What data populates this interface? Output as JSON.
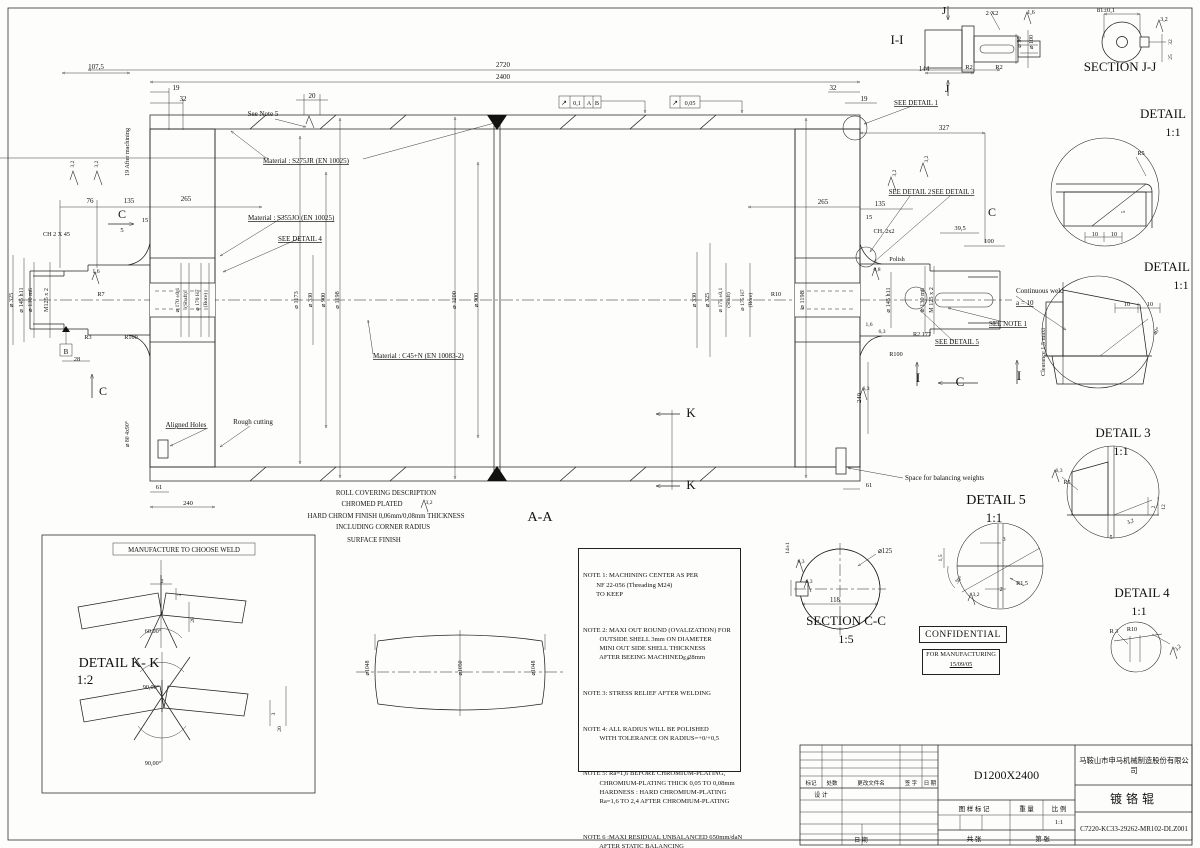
{
  "title_block": {
    "company": "马鞍山市申马机械制造股份有限公司",
    "part_name": "镀铬辊",
    "model": "D1200X2400",
    "drawing_number": "C7220-KC33-29262-MR102-DLZ001",
    "scale_value": "1:1",
    "col_mark": "标记",
    "col_count": "处数",
    "col_file": "更改文件名",
    "col_sign": "签 字",
    "col_date": "日 期",
    "design": "设 计",
    "date": "日 期",
    "pattern_mark": "图 样 标 记",
    "weight": "重 量",
    "scale": "比 例",
    "sheets_total": "共    张",
    "sheet_no": "第    张"
  },
  "confidential": {
    "label": "CONFIDENTIAL",
    "for_mfg": "FOR MANUFACTURING",
    "date": "15/09/05"
  },
  "notes": [
    "NOTE 1: MACHINING CENTER AS PER\n        NF 22-056 (Threading M24)\n        TO KEEP",
    "NOTE 2: MAXI OUT ROUND (OVALIZATION) FOR\n          OUTSIDE SHELL 3mm ON DIAMETER\n          MINI OUT SIDE SHELL THICKNESS\n          AFTER BEEING MACHINED : 28mm",
    "NOTE 3: STRESS RELIEF AFTER WELDING",
    "NOTE 4: ALL RADIUS WILL BE POLISHED\n          WITH TOLERANCE ON RADIUS=+0/+0,5",
    "NOTE 5: Ra=1,6 BEFORE CHROMIUM-PLATING,\n          CHROMIUM-PLATING THICK 0,05 TO 0,08mm\n          HARDNESS : HARD CHROMIUM-PLATING\n          Ra=1,6 TO 2,4 AFTER CHROMIUM-PLATING",
    "NOTE 6 :MAXI RESIDUAL UNBALANCED 650mm/daN\n          AFTER STATIC BALANCING"
  ],
  "labels": [
    {
      "t": "107,5",
      "x": 96,
      "y": 69
    },
    {
      "t": "2720",
      "x": 503,
      "y": 67
    },
    {
      "t": "2400",
      "x": 503,
      "y": 79
    },
    {
      "t": "19",
      "x": 176,
      "y": 90
    },
    {
      "t": "32",
      "x": 183,
      "y": 101
    },
    {
      "t": "20",
      "x": 312,
      "y": 98
    },
    {
      "t": "32",
      "x": 833,
      "y": 90
    },
    {
      "t": "19",
      "x": 864,
      "y": 101
    },
    {
      "t": "144",
      "x": 924,
      "y": 71
    },
    {
      "t": "2 X2",
      "x": 992,
      "y": 15,
      "s": 6.5
    },
    {
      "t": "1,6",
      "x": 1031,
      "y": 14,
      "s": 6
    },
    {
      "t": "R2",
      "x": 969,
      "y": 69,
      "s": 6.5
    },
    {
      "t": "R2",
      "x": 999,
      "y": 69,
      "s": 6.5
    },
    {
      "t": "J",
      "x": 944,
      "y": 14,
      "s": 11,
      "n": "section-mark-j"
    },
    {
      "t": "J",
      "x": 947,
      "y": 92,
      "s": 11,
      "n": "section-mark-j"
    },
    {
      "t": "I-I",
      "x": 897,
      "y": 44,
      "s": 13,
      "n": "view-label"
    },
    {
      "t": "⌀ 90",
      "x": 1021,
      "y": 42,
      "r": -90,
      "s": 6
    },
    {
      "t": "⌀ 100",
      "x": 1033,
      "y": 42,
      "r": -90,
      "s": 6
    },
    {
      "t": "81±0,1",
      "x": 1106,
      "y": 12,
      "s": 6.5
    },
    {
      "t": "3,2",
      "x": 1164,
      "y": 21,
      "s": 6
    },
    {
      "t": "32",
      "x": 1172,
      "y": 42,
      "r": -90,
      "s": 5.5
    },
    {
      "t": "25",
      "x": 1172,
      "y": 57,
      "r": -90,
      "s": 5.5
    },
    {
      "t": "SECTION J-J",
      "x": 1120,
      "y": 71,
      "s": 13,
      "n": "view-label"
    },
    {
      "t": "SEE DETAIL 1",
      "x": 916,
      "y": 105,
      "s": 7,
      "u": 1
    },
    {
      "t": "See Note 5",
      "x": 263,
      "y": 116,
      "s": 7
    },
    {
      "t": "19 After machining",
      "x": 129,
      "y": 152,
      "r": -90,
      "s": 6.2
    },
    {
      "t": "Material : S275JR (EN 10025)",
      "x": 263,
      "y": 163,
      "s": 7,
      "u": 1,
      "a": "start"
    },
    {
      "t": "Material : S355JO (EN 10025)",
      "x": 248,
      "y": 220,
      "s": 7,
      "u": 1,
      "a": "start"
    },
    {
      "t": "SEE DETAIL 4",
      "x": 278,
      "y": 241,
      "s": 7,
      "u": 1,
      "a": "start"
    },
    {
      "t": "Material : C45+N (EN 10083-2)",
      "x": 373,
      "y": 358,
      "s": 7,
      "u": 1,
      "a": "start"
    },
    {
      "t": "76",
      "x": 90,
      "y": 203
    },
    {
      "t": "135",
      "x": 129,
      "y": 203
    },
    {
      "t": "265",
      "x": 186,
      "y": 201
    },
    {
      "t": "C",
      "x": 122,
      "y": 218,
      "s": 12,
      "n": "section-mark-c"
    },
    {
      "t": "15",
      "x": 145,
      "y": 222,
      "s": 6.5
    },
    {
      "t": "5",
      "x": 122,
      "y": 232,
      "s": 6.5
    },
    {
      "t": "CH 2 X 45",
      "x": 43,
      "y": 236,
      "s": 6.2,
      "a": "start"
    },
    {
      "t": "3,2",
      "x": 74,
      "y": 164,
      "r": -90,
      "s": 5.5
    },
    {
      "t": "3,2",
      "x": 98,
      "y": 164,
      "r": -90,
      "s": 5.5
    },
    {
      "t": "⌀ 325",
      "x": 13,
      "y": 300,
      "r": -90,
      "s": 6.2
    },
    {
      "t": "⌀ 145 h11",
      "x": 23,
      "y": 300,
      "r": -90,
      "s": 6.2
    },
    {
      "t": "⌀ 130 m6",
      "x": 32,
      "y": 300,
      "r": -90,
      "s": 6.2
    },
    {
      "t": "M125 x 2",
      "x": 48,
      "y": 300,
      "r": -90,
      "s": 6.2
    },
    {
      "t": "R7",
      "x": 101,
      "y": 296,
      "s": 6.2
    },
    {
      "t": "1,6",
      "x": 96,
      "y": 273,
      "s": 5.8
    },
    {
      "t": "R3",
      "x": 88,
      "y": 339,
      "s": 6.2
    },
    {
      "t": "R100",
      "x": 131,
      "y": 339,
      "s": 6.2
    },
    {
      "t": "28",
      "x": 77,
      "y": 361,
      "s": 6.5
    },
    {
      "t": "C",
      "x": 103,
      "y": 395,
      "s": 12,
      "n": "section-mark-c"
    },
    {
      "t": "B",
      "x": 66,
      "y": 354,
      "s": 7,
      "n": "datum-label"
    },
    {
      "t": "⌀ 170 ±0,1",
      "x": 179,
      "y": 300,
      "r": -90,
      "s": 5.6
    },
    {
      "t": "(Shaft)",
      "x": 187,
      "y": 300,
      "r": -90,
      "s": 5.6
    },
    {
      "t": "⌀ 170 H7",
      "x": 199,
      "y": 300,
      "r": -90,
      "s": 5.6
    },
    {
      "t": "(Bore)",
      "x": 207,
      "y": 300,
      "r": -90,
      "s": 5.6
    },
    {
      "t": "⌀ 1173",
      "x": 298,
      "y": 300,
      "r": -90,
      "s": 6.2
    },
    {
      "t": "⌀ 330",
      "x": 312,
      "y": 300,
      "r": -90,
      "s": 6.2
    },
    {
      "t": "⌀ 900",
      "x": 325,
      "y": 300,
      "r": -90,
      "s": 6.2
    },
    {
      "t": "⌀ 1198",
      "x": 339,
      "y": 300,
      "r": -90,
      "s": 6.2
    },
    {
      "t": "⌀ 1200",
      "x": 456,
      "y": 300,
      "r": -90,
      "s": 6.2
    },
    {
      "t": "⌀ 900",
      "x": 478,
      "y": 300,
      "r": -90,
      "s": 6.2
    },
    {
      "t": "⌀ 330",
      "x": 696,
      "y": 300,
      "r": -90,
      "s": 6.2
    },
    {
      "t": "⌀ 325",
      "x": 709,
      "y": 300,
      "r": -90,
      "s": 6.2
    },
    {
      "t": "⌀ 175 ±0,1",
      "x": 722,
      "y": 300,
      "r": -90,
      "s": 5.6
    },
    {
      "t": "(Shaft)",
      "x": 730,
      "y": 300,
      "r": -90,
      "s": 5.6
    },
    {
      "t": "⌀ 175 H7",
      "x": 744,
      "y": 300,
      "r": -90,
      "s": 5.6
    },
    {
      "t": "(Bore)",
      "x": 752,
      "y": 300,
      "r": -90,
      "s": 5.6
    },
    {
      "t": "R10",
      "x": 776,
      "y": 296,
      "s": 6.2
    },
    {
      "t": "⌀ 1198",
      "x": 804,
      "y": 300,
      "r": -90,
      "s": 6.2
    },
    {
      "t": "265",
      "x": 823,
      "y": 204
    },
    {
      "t": "135",
      "x": 880,
      "y": 206
    },
    {
      "t": "15",
      "x": 869,
      "y": 219,
      "s": 6.5
    },
    {
      "t": "CH. 2x2",
      "x": 884,
      "y": 233,
      "s": 6.2
    },
    {
      "t": "39,5",
      "x": 960,
      "y": 230,
      "s": 6.5
    },
    {
      "t": "100",
      "x": 989,
      "y": 243,
      "s": 6.5
    },
    {
      "t": "Polish",
      "x": 897,
      "y": 261,
      "s": 6.2
    },
    {
      "t": "0,8",
      "x": 877,
      "y": 271,
      "s": 5.6
    },
    {
      "t": "C",
      "x": 992,
      "y": 216,
      "s": 12,
      "n": "section-mark-c"
    },
    {
      "t": "3,2",
      "x": 896,
      "y": 173,
      "r": -90,
      "s": 5.5
    },
    {
      "t": "3,2",
      "x": 928,
      "y": 159,
      "r": -90,
      "s": 5.5
    },
    {
      "t": "327",
      "x": 944,
      "y": 130
    },
    {
      "t": "SEE DETAIL 2",
      "x": 910,
      "y": 194,
      "s": 6.8,
      "u": 1
    },
    {
      "t": "SEE DETAIL 3",
      "x": 953,
      "y": 194,
      "s": 6.8,
      "u": 1
    },
    {
      "t": "⌀ 145 h11",
      "x": 890,
      "y": 300,
      "r": -90,
      "s": 6.2
    },
    {
      "t": "⌀ 130 m6",
      "x": 924,
      "y": 300,
      "r": -90,
      "s": 6.2
    },
    {
      "t": "M 125 x 2",
      "x": 933,
      "y": 300,
      "r": -90,
      "s": 6.2
    },
    {
      "t": "R2 177",
      "x": 922,
      "y": 336,
      "s": 6.2
    },
    {
      "t": "R100",
      "x": 896,
      "y": 356,
      "s": 6.2
    },
    {
      "t": "6,3",
      "x": 882,
      "y": 333,
      "s": 5.6
    },
    {
      "t": "1,6",
      "x": 869,
      "y": 326,
      "s": 5.6
    },
    {
      "t": "SEE NOTE 1",
      "x": 1008,
      "y": 326,
      "s": 7,
      "u": 1
    },
    {
      "t": "SEE DETAIL 5",
      "x": 957,
      "y": 344,
      "s": 7,
      "u": 1
    },
    {
      "t": "Continuous weld",
      "x": 1016,
      "y": 293,
      "s": 7,
      "a": "start"
    },
    {
      "t": "a = 10",
      "x": 1016,
      "y": 305,
      "s": 7,
      "a": "start",
      "u": 1
    },
    {
      "t": "Clearance 1,5 maxi",
      "x": 1045,
      "y": 352,
      "r": -90,
      "s": 6.2
    },
    {
      "t": "I",
      "x": 918,
      "y": 382,
      "s": 13,
      "n": "section-mark-i"
    },
    {
      "t": "I",
      "x": 1019,
      "y": 380,
      "s": 13,
      "n": "section-mark-i"
    },
    {
      "t": "C",
      "x": 960,
      "y": 386,
      "s": 13,
      "n": "section-mark-c"
    },
    {
      "t": "240",
      "x": 861,
      "y": 398,
      "r": -90,
      "s": 6.5
    },
    {
      "t": "61",
      "x": 869,
      "y": 487,
      "s": 6.5
    },
    {
      "t": "6,3",
      "x": 866,
      "y": 390,
      "s": 5.6
    },
    {
      "t": "Space for balancing weights",
      "x": 905,
      "y": 480,
      "s": 7,
      "a": "start"
    },
    {
      "t": "⌀ 80 4x90°",
      "x": 129,
      "y": 434,
      "r": -90,
      "s": 5.8
    },
    {
      "t": "Aligned Holes",
      "x": 186,
      "y": 427,
      "s": 7,
      "u": 1
    },
    {
      "t": "Rough cutting",
      "x": 253,
      "y": 424,
      "s": 7
    },
    {
      "t": "61",
      "x": 159,
      "y": 489,
      "s": 6.5
    },
    {
      "t": "240",
      "x": 188,
      "y": 505,
      "s": 6.5
    },
    {
      "t": "K",
      "x": 691,
      "y": 417,
      "s": 13,
      "n": "section-mark-k"
    },
    {
      "t": "K",
      "x": 691,
      "y": 489,
      "s": 13,
      "n": "section-mark-k"
    },
    {
      "t": "A-A",
      "x": 540,
      "y": 521,
      "s": 14,
      "n": "view-label"
    },
    {
      "t": "ROLL COVERING DESCRIPTION",
      "x": 386,
      "y": 495,
      "s": 6.8
    },
    {
      "t": "CHROMED PLATED",
      "x": 372,
      "y": 506,
      "s": 6.8
    },
    {
      "t": "3,2",
      "x": 429,
      "y": 504,
      "s": 5.6
    },
    {
      "t": "HARD CHROM FINISH 0,06mm/0,08mm THICKNESS",
      "x": 386,
      "y": 518,
      "s": 6.8
    },
    {
      "t": "INCLUDING CORNER RADIUS",
      "x": 383,
      "y": 529,
      "s": 6.8
    },
    {
      "t": "SURFACE FINISH",
      "x": 374,
      "y": 542,
      "s": 6.8
    },
    {
      "t": "10",
      "x": 1095,
      "y": 236,
      "s": 6.2
    },
    {
      "t": "10",
      "x": 1114,
      "y": 236,
      "s": 6.2
    },
    {
      "t": "5",
      "x": 1125,
      "y": 212,
      "r": -90,
      "s": 5.6
    },
    {
      "t": "R5",
      "x": 1141,
      "y": 155,
      "s": 6.2
    },
    {
      "t": "DETAIL",
      "x": 1163,
      "y": 118,
      "s": 13,
      "n": "view-label"
    },
    {
      "t": "1:1",
      "x": 1173,
      "y": 136,
      "s": 12
    },
    {
      "t": "DETAIL",
      "x": 1167,
      "y": 271,
      "s": 13,
      "n": "view-label"
    },
    {
      "t": "1:1",
      "x": 1181,
      "y": 289,
      "s": 12
    },
    {
      "t": "10",
      "x": 1127,
      "y": 306,
      "s": 6.2
    },
    {
      "t": "10",
      "x": 1150,
      "y": 306,
      "s": 6.2
    },
    {
      "t": "40°",
      "x": 1158,
      "y": 332,
      "r": -60,
      "s": 5.8
    },
    {
      "t": "DETAIL 3",
      "x": 1123,
      "y": 437,
      "s": 13,
      "n": "view-label"
    },
    {
      "t": "1:1",
      "x": 1121,
      "y": 455,
      "s": 12
    },
    {
      "t": "6,3",
      "x": 1059,
      "y": 472,
      "s": 5.6
    },
    {
      "t": "R5",
      "x": 1067,
      "y": 484,
      "s": 6
    },
    {
      "t": "5",
      "x": 1111,
      "y": 539,
      "s": 6.2
    },
    {
      "t": "3,2",
      "x": 1131,
      "y": 523,
      "r": -20,
      "s": 5.6
    },
    {
      "t": "2",
      "x": 1155,
      "y": 507,
      "r": -90,
      "s": 5.6
    },
    {
      "t": "12",
      "x": 1165,
      "y": 507,
      "r": -90,
      "s": 5.6
    },
    {
      "t": "DETAIL 5",
      "x": 996,
      "y": 504,
      "s": 14,
      "n": "view-label"
    },
    {
      "t": "1:1",
      "x": 994,
      "y": 522,
      "s": 13
    },
    {
      "t": "3",
      "x": 1004,
      "y": 541,
      "s": 6.2
    },
    {
      "t": "1,5",
      "x": 942,
      "y": 558,
      "r": -90,
      "s": 5.6
    },
    {
      "t": "30°",
      "x": 960,
      "y": 581,
      "r": -45,
      "s": 5.6
    },
    {
      "t": "3,2",
      "x": 976,
      "y": 596,
      "s": 5.6
    },
    {
      "t": "2",
      "x": 1001,
      "y": 591,
      "s": 6.2
    },
    {
      "t": "R1,5",
      "x": 1022,
      "y": 585,
      "s": 6.2
    },
    {
      "t": "DETAIL 4",
      "x": 1142,
      "y": 597,
      "s": 13,
      "n": "view-label"
    },
    {
      "t": "1:1",
      "x": 1139,
      "y": 615,
      "s": 12
    },
    {
      "t": "R 3",
      "x": 1114,
      "y": 633,
      "s": 6.2
    },
    {
      "t": "R10",
      "x": 1132,
      "y": 631,
      "s": 6.2
    },
    {
      "t": "3,2",
      "x": 1179,
      "y": 649,
      "r": -45,
      "s": 5.6
    },
    {
      "t": "⌀125",
      "x": 885,
      "y": 553,
      "s": 6.8
    },
    {
      "t": "118",
      "x": 835,
      "y": 602,
      "s": 6.8
    },
    {
      "t": "14±1",
      "x": 789,
      "y": 548,
      "r": -90,
      "s": 5.6
    },
    {
      "t": "6,3",
      "x": 801,
      "y": 563,
      "s": 5.6
    },
    {
      "t": "6,3",
      "x": 809,
      "y": 583,
      "s": 5.6
    },
    {
      "t": "SECTION C-C",
      "x": 846,
      "y": 625,
      "s": 13,
      "n": "view-label"
    },
    {
      "t": "1:5",
      "x": 846,
      "y": 643,
      "s": 12
    },
    {
      "t": "MANUFACTURE TO CHOOSE WELD",
      "x": 184,
      "y": 552,
      "s": 6.8
    },
    {
      "t": "2",
      "x": 162,
      "y": 583,
      "s": 6.2
    },
    {
      "t": "3",
      "x": 181,
      "y": 595,
      "r": -90,
      "s": 5.6
    },
    {
      "t": "20",
      "x": 194,
      "y": 620,
      "r": -90,
      "s": 5.6
    },
    {
      "t": "60,00°",
      "x": 153,
      "y": 633,
      "s": 6.2
    },
    {
      "t": "DETAIL K- K",
      "x": 119,
      "y": 667,
      "s": 14,
      "n": "view-label"
    },
    {
      "t": "1:2",
      "x": 85,
      "y": 684,
      "s": 13
    },
    {
      "t": "90,00°",
      "x": 151,
      "y": 689,
      "s": 6.2
    },
    {
      "t": "90,00°",
      "x": 153,
      "y": 765,
      "s": 6.2
    },
    {
      "t": "3",
      "x": 275,
      "y": 714,
      "r": -90,
      "s": 5.6
    },
    {
      "t": "20",
      "x": 281,
      "y": 729,
      "r": -90,
      "s": 5.6
    },
    {
      "t": "⌀1048",
      "x": 369,
      "y": 668,
      "r": -90,
      "s": 5.8
    },
    {
      "t": "⌀1050",
      "x": 462,
      "y": 668,
      "r": -90,
      "s": 5.8
    },
    {
      "t": "⌀1048",
      "x": 535,
      "y": 668,
      "r": -90,
      "s": 5.8
    },
    {
      "t": "0,8",
      "x": 686,
      "y": 660,
      "s": 5.4
    },
    {
      "t": "↗",
      "x": 564,
      "y": 105,
      "s": 7,
      "n": "gdt-symbol"
    },
    {
      "t": "0,1",
      "x": 577,
      "y": 105,
      "s": 6.2
    },
    {
      "t": "A",
      "x": 589,
      "y": 105,
      "s": 6.2
    },
    {
      "t": "B",
      "x": 597,
      "y": 105,
      "s": 6.2
    },
    {
      "t": "↗",
      "x": 675,
      "y": 105,
      "s": 7,
      "n": "gdt-symbol"
    },
    {
      "t": "0,05",
      "x": 690,
      "y": 105,
      "s": 6.2
    }
  ]
}
